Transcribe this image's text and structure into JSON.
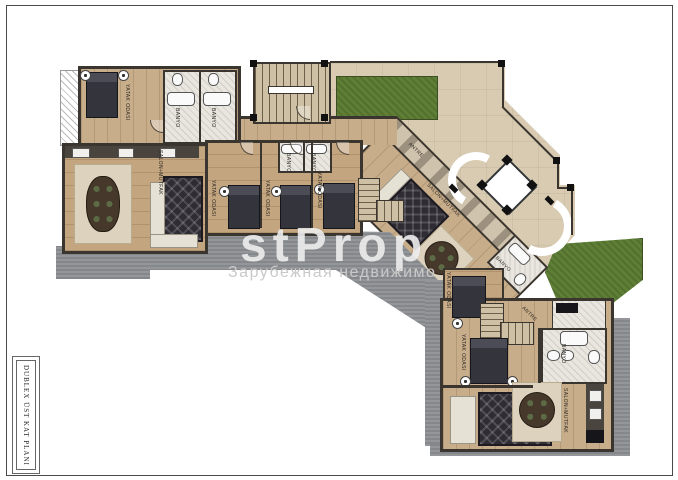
{
  "sheet": {
    "side_title": "DUBLEX ÜST KAT PLANI"
  },
  "watermark": {
    "logo": "stProp",
    "tagline": "Зарубежная недвижимо"
  },
  "rooms": [
    {
      "id": "bedroom-topleft",
      "label": "YATAK ODASI"
    },
    {
      "id": "bath-topleft-1",
      "label": "BANYO"
    },
    {
      "id": "bath-topleft-2",
      "label": "BANYO"
    },
    {
      "id": "living-left",
      "label": "SALON+MUTFAK"
    },
    {
      "id": "bedroom-mid-a",
      "label": "YATAK ODASI"
    },
    {
      "id": "bath-mid-1",
      "label": "BANYO"
    },
    {
      "id": "bath-mid-2",
      "label": "BANYO"
    },
    {
      "id": "bedroom-mid-b",
      "label": "YATAK ODASI"
    },
    {
      "id": "bedroom-mid-c",
      "label": "YATAK ODASI"
    },
    {
      "id": "entry-diagonal",
      "label": "ANTRE"
    },
    {
      "id": "living-diagonal",
      "label": "SALON+MUTFAK"
    },
    {
      "id": "bath-diagonal",
      "label": "BANYO"
    },
    {
      "id": "bedroom-right-mid",
      "label": "YATAK ODASI"
    },
    {
      "id": "entry-bottomright",
      "label": "ANTRE"
    },
    {
      "id": "bedroom-bottomright",
      "label": "YATAK ODASI"
    },
    {
      "id": "bath-bottomright",
      "label": "BANYO"
    },
    {
      "id": "living-bottomright",
      "label": "SALON+MUTFAK"
    }
  ],
  "colors": {
    "wood": "#c8ad8a",
    "wall": "#3a362f",
    "terrace_gray": "#8d9093",
    "terrace_beige": "#d9cbb2",
    "grass": "#5e7f35",
    "marble": "#e9e6e0",
    "rug": "#2f2c33",
    "watermark": "#c9c9c9"
  }
}
